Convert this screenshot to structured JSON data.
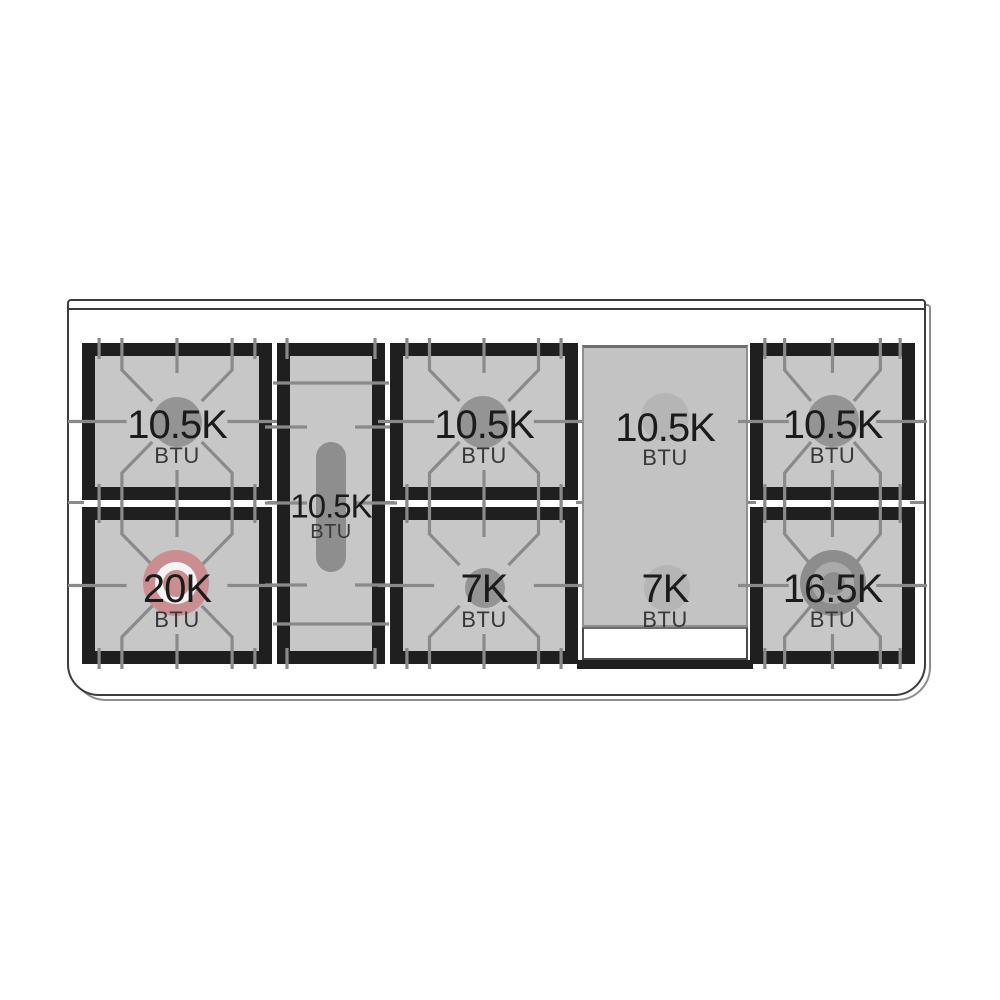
{
  "diagram_title": "gas range cooktop burner layout",
  "cooktop": {
    "colors": {
      "outline": "#3c3c3c",
      "frame": "#1f1f1f",
      "surface": "#c7c7c7",
      "grate_line": "#8a8a8a",
      "cap": "#949494",
      "cap_light": "#b5b5b5",
      "highlight": "#ca8e90"
    },
    "burners": [
      {
        "position": "left-rear",
        "btu": "10.5K",
        "unit": "BTU"
      },
      {
        "position": "left-front",
        "btu": "20K",
        "unit": "BTU",
        "highlighted": true
      },
      {
        "position": "center-oval",
        "btu": "10.5K",
        "unit": "BTU"
      },
      {
        "position": "middle-rear",
        "btu": "10.5K",
        "unit": "BTU"
      },
      {
        "position": "middle-front",
        "btu": "7K",
        "unit": "BTU"
      },
      {
        "position": "griddle-rear",
        "btu": "10.5K",
        "unit": "BTU"
      },
      {
        "position": "griddle-front",
        "btu": "7K",
        "unit": "BTU"
      },
      {
        "position": "right-rear",
        "btu": "10.5K",
        "unit": "BTU"
      },
      {
        "position": "right-front",
        "btu": "16.5K",
        "unit": "BTU"
      }
    ]
  }
}
